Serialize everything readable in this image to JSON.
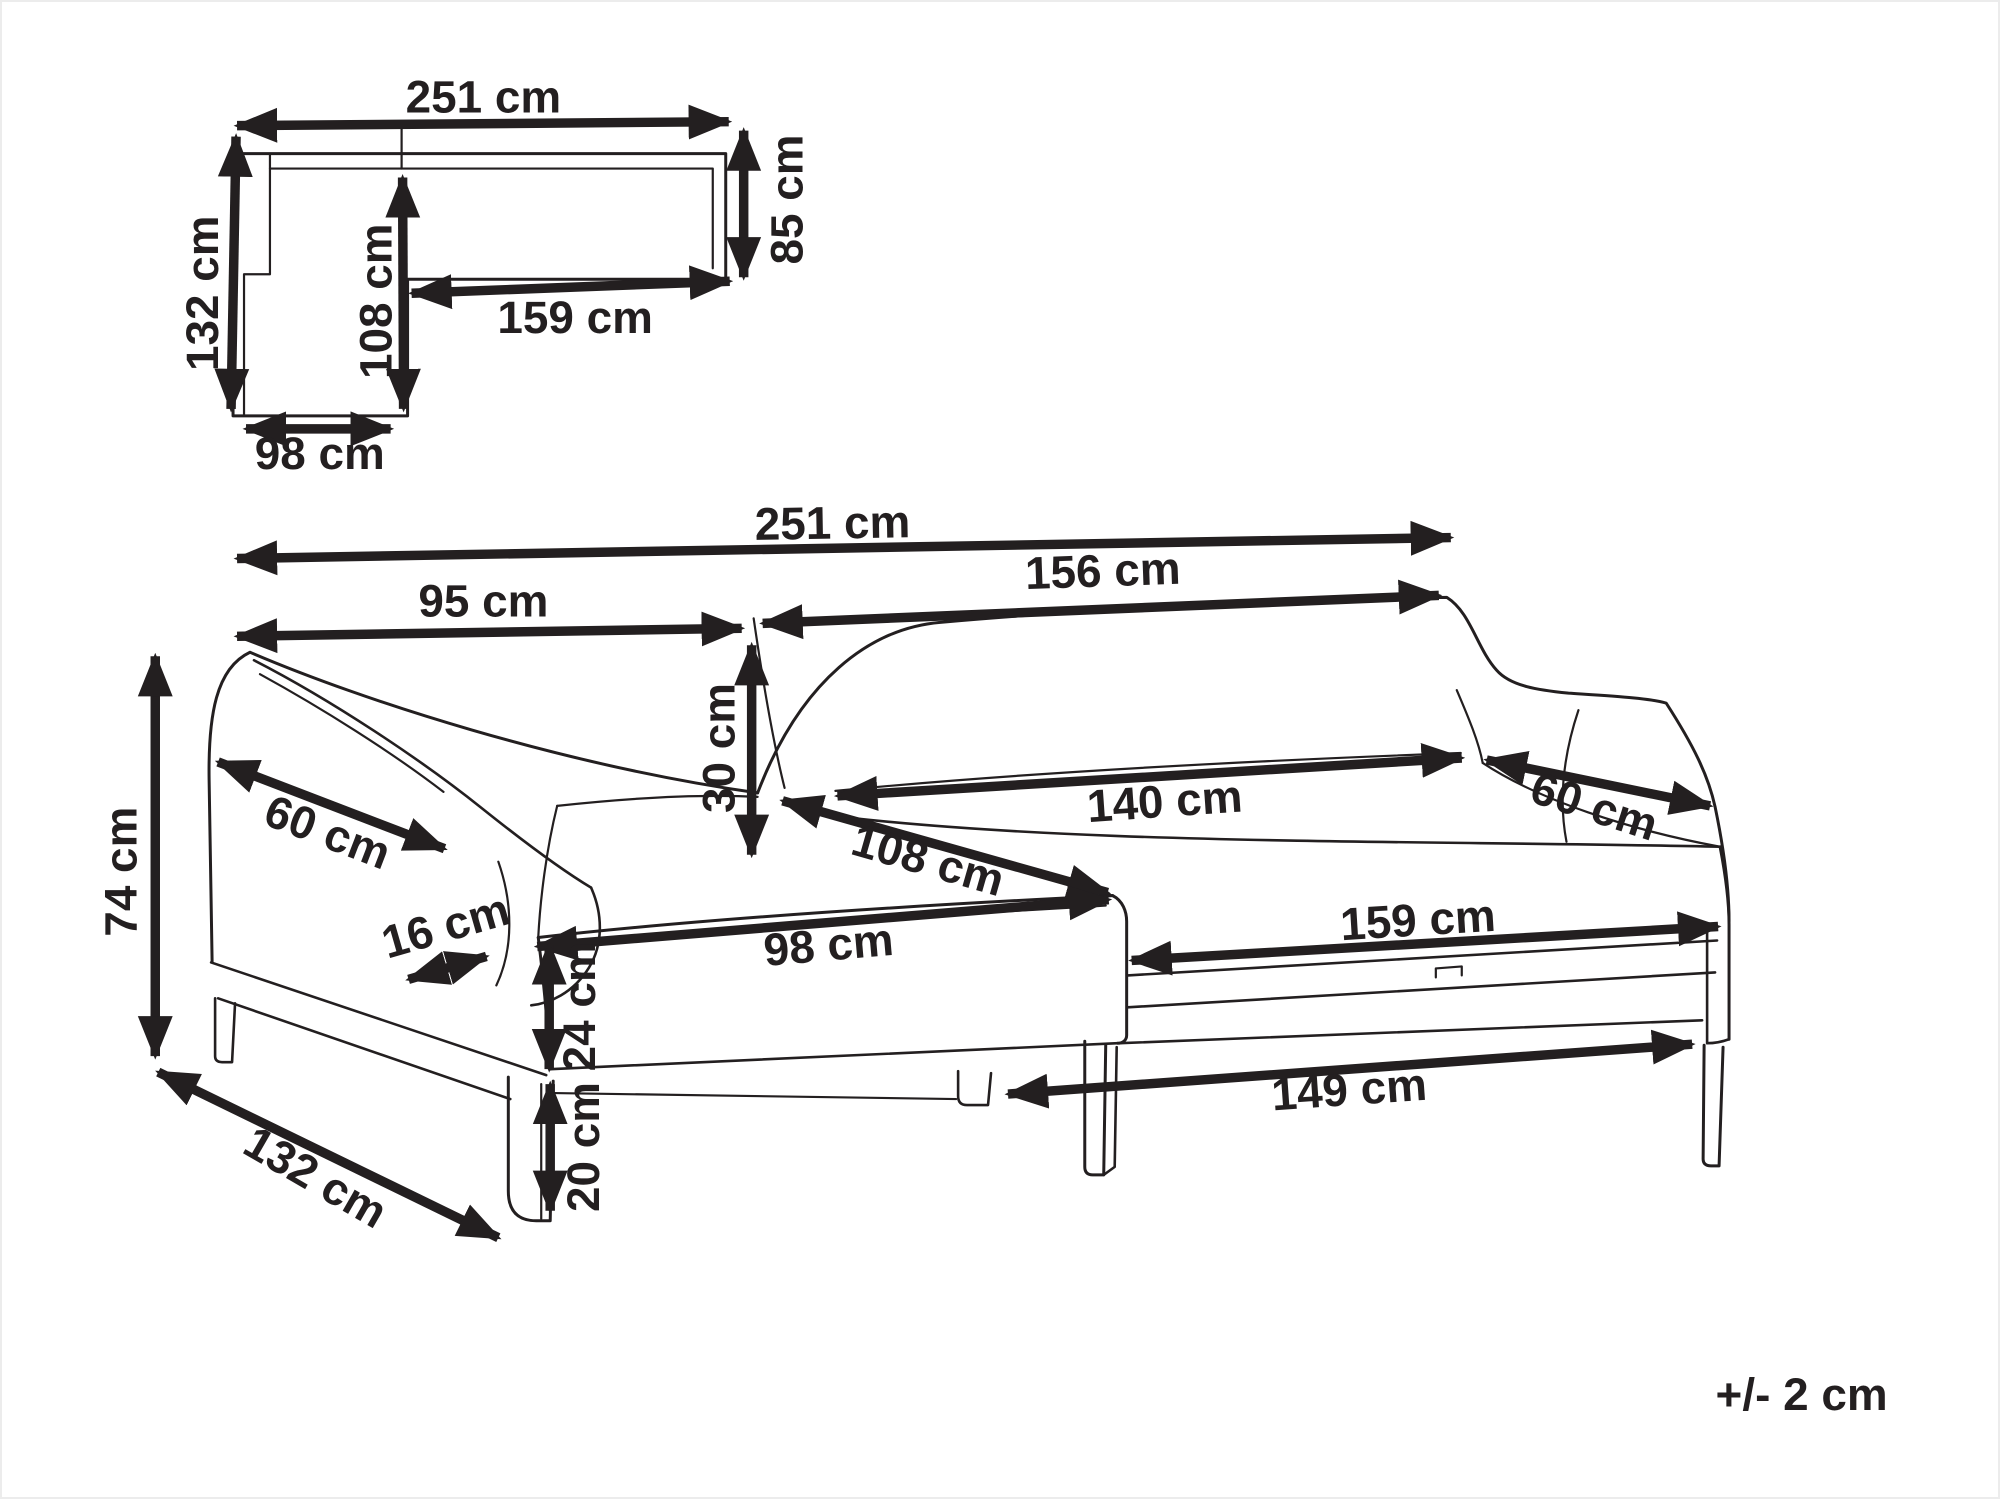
{
  "meta": {
    "type": "furniture-dimension-diagram",
    "subject": "corner-sofa-with-chaise"
  },
  "tolerance_note": "+/- 2 cm",
  "plan_view": {
    "labels": {
      "total_width": "251 cm",
      "left_depth": "132 cm",
      "inner_depth": "108 cm",
      "inner_width": "159 cm",
      "right_depth": "85 cm",
      "chaise_width": "98 cm"
    }
  },
  "perspective_view": {
    "labels": {
      "total_width": "251 cm",
      "left_section_width": "95 cm",
      "right_section_width": "156 cm",
      "backrest_height": "30 cm",
      "left_armrest_depth": "60 cm",
      "armrest_thickness": "16 cm",
      "chaise_length": "108 cm",
      "seat_width": "140 cm",
      "right_armrest_depth": "60 cm",
      "chaise_front_width": "98 cm",
      "seat_base_height": "24 cm",
      "leg_height": "20 cm",
      "seat_front_length": "159 cm",
      "base_length": "149 cm",
      "total_height": "74 cm",
      "total_depth": "132 cm"
    }
  }
}
